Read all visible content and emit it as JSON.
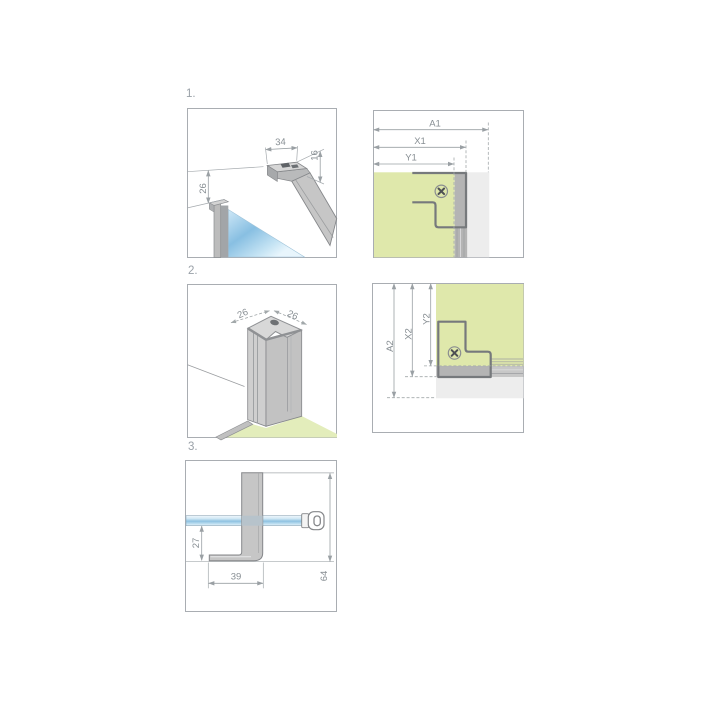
{
  "document": {
    "type": "installation-diagram",
    "background": "#ffffff"
  },
  "title_labels": {
    "step1": "1.",
    "step2": "2.",
    "step3": "3."
  },
  "panel1": {
    "description": "support-bar-and-glass-detail",
    "dims": {
      "width": "34",
      "height": "16",
      "offset": "26"
    }
  },
  "panel2": {
    "description": "corner-top-view",
    "dims": {
      "a": "A1",
      "x": "X1",
      "y": "Y1"
    }
  },
  "panel3": {
    "description": "corner-profile-isometric",
    "dims": {
      "left": "26",
      "right": "26"
    }
  },
  "panel4": {
    "description": "corner-side-view",
    "dims": {
      "a": "A2",
      "x": "X2",
      "y": "Y2"
    }
  },
  "panel5": {
    "description": "wall-bracket-side-view",
    "dims": {
      "offset": "27",
      "foot": "39",
      "height": "64"
    }
  },
  "icons": {
    "screw": "phillips-screw-head"
  },
  "colors": {
    "panel_green": "#dfe8ab",
    "floor_green": "#e3edbb",
    "glass_blue": "#8fc2e1",
    "profile_dark_gray": "#b4b4b4",
    "profile_mid_gray": "#c7c7c7",
    "profile_light_gray": "#ededed",
    "line_gray": "#85878a",
    "text_gray": "#878e93"
  }
}
